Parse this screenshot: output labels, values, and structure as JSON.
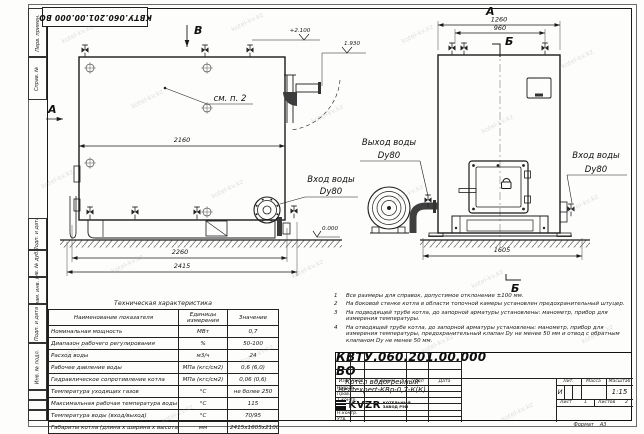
{
  "watermark_text": "kotel-kv.kz",
  "corner_stamp": {
    "doc_number": "КВТУ.060.201.00.000  ВО"
  },
  "frame_labels": {
    "perv_primen": "Перв. примен.",
    "sprav_no": "Справ. №",
    "podp_data_1": "Подп. и дата",
    "inv_dubl": "Инв. № дубл.",
    "vzam_inv": "Взам. инв. №",
    "podp_data_2": "Подп. и дата",
    "inv_podl": "Инв. № подл.",
    "format_label": "Формат",
    "format_value": "А3"
  },
  "front_view": {
    "section_mark": "В",
    "view_arrow": "А",
    "dim_top": "2160",
    "dim_mid": "2260",
    "dim_bottom": "2415",
    "elev_top": "+2.100",
    "elev_outlet": "1.930",
    "elev_zero": "0.000",
    "callout": "см. п. 2",
    "inlet_line1": "Вход воды",
    "inlet_line2": "Dy80"
  },
  "side_view": {
    "view_title": "А",
    "section_top": "Б",
    "section_bottom": "Б",
    "dim_top": "1260",
    "dim_inner": "960",
    "dim_bottom": "1605",
    "outlet_line1": "Выход воды",
    "outlet_line2": "Dy80",
    "inlet_line1": "Вход воды",
    "inlet_line2": "Dy80"
  },
  "spec_table": {
    "title": "Техническая характеристика",
    "headers": [
      "Наименование показателя",
      "Единицы измерения",
      "Значение"
    ],
    "rows": [
      [
        "Номинальная мощность",
        "МВт",
        "0,7"
      ],
      [
        "Диапазон рабочего регулирования",
        "%",
        "50-100"
      ],
      [
        "Расход воды",
        "м3/ч",
        "24"
      ],
      [
        "Рабочее давление воды",
        "МПа (кгс/см2)",
        "0,6 (6,0)"
      ],
      [
        "Гидравлическое сопротивление котла",
        "МПа (кгс/см2)",
        "0,06 (0,6)"
      ],
      [
        "Температура уходящих газов",
        "°С",
        "не более 250"
      ],
      [
        "Максимальная рабочая температура воды",
        "°С",
        "115"
      ],
      [
        "Температура воды (вход/выход)",
        "°С",
        "70/95"
      ],
      [
        "Габариты котла (длина х ширина х высота)",
        "мм",
        "2415х1605х2100"
      ]
    ]
  },
  "notes": [
    {
      "num": "1",
      "text": "Все размеры для справок, допустимое отклонение ±100 мм."
    },
    {
      "num": "2",
      "text": "На боковой стенке котла в области топочной камеры установлен предохранительный штуцер."
    },
    {
      "num": "3",
      "text": "На  подводящей трубе котла, до запорной арматуры установлены: манометр, прибор для измерения температуры."
    },
    {
      "num": "4",
      "text": "На отводящей трубе котла, до запорной арматуры установлены: манометр, прибор для измерения температуры, предохранительный клапан Dу не менее 50 мм и отвод с обратным клапаном Dу не менее 50 мм."
    }
  ],
  "title_block": {
    "doc_number": "КВТУ.060.201.00.000  ВО",
    "name_line1": "Котел водогрейный",
    "name_line2": "Heatexpert-КВр-0,7-К(К)",
    "col_izm": "Изм",
    "col_list": "Лист",
    "col_doc": "N докум.",
    "col_sign": "Подп",
    "col_date": "Дата",
    "role_1": "Разраб.",
    "role_2": "Пров.",
    "role_3": "Т.контр.",
    "role_4": "Н.контр.",
    "role_5": "Утв.",
    "lit_label": "Лит.",
    "mass_label": "Масса",
    "scale_label": "Масштаб",
    "lit_value": "И",
    "scale_value": "1:15",
    "sheet_label": "Лист",
    "sheet_value": "1",
    "sheets_label": "Листов",
    "sheets_value": "2",
    "logo": "KVZR",
    "org_line1": "КОТЕЛЬНЫЙ",
    "org_line2": "ЗАВОД РЭП"
  }
}
